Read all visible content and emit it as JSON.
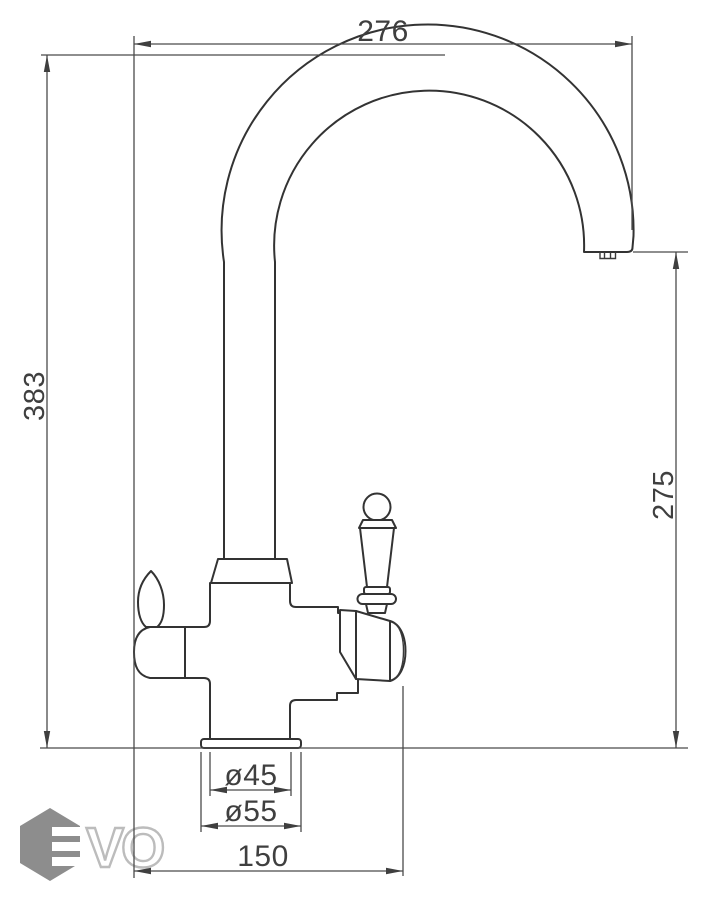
{
  "drawing": {
    "type": "faucet-dimensional-diagram",
    "dimensions": {
      "spout_reach_top": "276",
      "total_height_left": "383",
      "spout_outlet_height_right": "275",
      "base_inner_diameter": "ø45",
      "base_outer_diameter": "ø55",
      "handle_span_bottom": "150"
    },
    "colors": {
      "background": "#ffffff",
      "object_line": "#333333",
      "dimension_line": "#4b4b4b",
      "text": "#3f3f3f",
      "logo_gray": "#8d8d8d",
      "logo_outline": "#bcbcbc"
    }
  },
  "watermark": {
    "logo_text": "VO"
  }
}
